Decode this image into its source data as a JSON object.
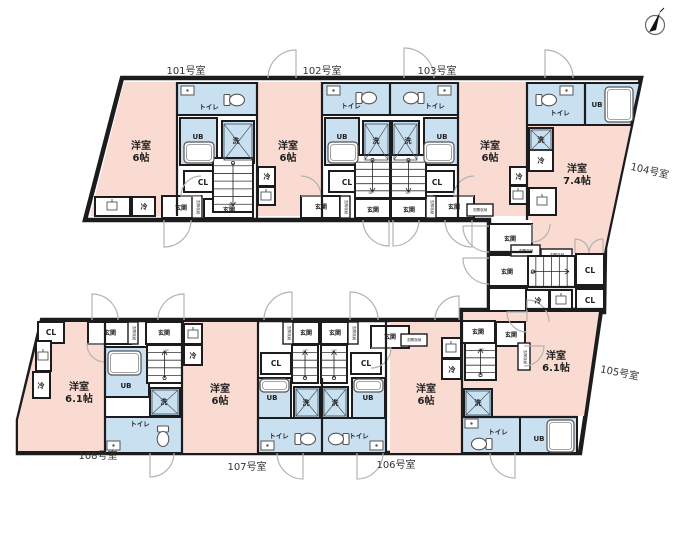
{
  "colors": {
    "wall": "#1c1c1e",
    "room_pink": "#f9dbd2",
    "wet_blue": "#c9e0f1",
    "door_arc": "#b3b3b3",
    "background": "#ffffff"
  },
  "units": [
    {
      "no": "101号室",
      "room": "洋室",
      "size": "6帖"
    },
    {
      "no": "102号室",
      "room": "洋室",
      "size": "6帖"
    },
    {
      "no": "103号室",
      "room": "洋室",
      "size": "6帖"
    },
    {
      "no": "104号室",
      "room": "洋室",
      "size": "7.4帖"
    },
    {
      "no": "105号室",
      "room": "洋室",
      "size": "6.1帖"
    },
    {
      "no": "106号室",
      "room": "洋室",
      "size": "6帖"
    },
    {
      "no": "107号室",
      "room": "洋室",
      "size": "6帖"
    },
    {
      "no": "108号室",
      "room": "洋室",
      "size": "6.1帖"
    }
  ],
  "legend": {
    "toilet": "トイレ",
    "unit_bath": "UB",
    "washer": "洗",
    "closet": "CL",
    "entrance": "玄関",
    "entrance_storage": "玄関収納",
    "fridge": "冷",
    "stairs_up": "UP"
  },
  "labels": [
    {
      "id": "unit-101",
      "t": "101号室",
      "x": 186,
      "y": 74,
      "c": "t-unit"
    },
    {
      "id": "unit-102",
      "t": "102号室",
      "x": 322,
      "y": 74,
      "c": "t-unit"
    },
    {
      "id": "unit-103",
      "t": "103号室",
      "x": 437,
      "y": 74,
      "c": "t-unit"
    },
    {
      "id": "unit-104",
      "t": "104号室",
      "x": 649,
      "y": 174,
      "c": "t-unit",
      "r": 13
    },
    {
      "id": "unit-105",
      "t": "105号室",
      "x": 619,
      "y": 376,
      "c": "t-unit",
      "r": 11
    },
    {
      "id": "unit-106",
      "t": "106号室",
      "x": 396,
      "y": 468,
      "c": "t-unit"
    },
    {
      "id": "unit-107",
      "t": "107号室",
      "x": 247,
      "y": 470,
      "c": "t-unit"
    },
    {
      "id": "unit-108",
      "t": "108号室",
      "x": 98,
      "y": 459,
      "c": "t-unit"
    },
    {
      "id": "room-101-type",
      "t": "洋室",
      "x": 141,
      "y": 149,
      "c": "t-room"
    },
    {
      "id": "room-101-size",
      "t": "6帖",
      "x": 141,
      "y": 161,
      "c": "t-room"
    },
    {
      "id": "room-102-type",
      "t": "洋室",
      "x": 288,
      "y": 149,
      "c": "t-room"
    },
    {
      "id": "room-102-size",
      "t": "6帖",
      "x": 288,
      "y": 161,
      "c": "t-room"
    },
    {
      "id": "room-103-type",
      "t": "洋室",
      "x": 490,
      "y": 149,
      "c": "t-room"
    },
    {
      "id": "room-103-size",
      "t": "6帖",
      "x": 490,
      "y": 161,
      "c": "t-room"
    },
    {
      "id": "room-104-type",
      "t": "洋室",
      "x": 577,
      "y": 172,
      "c": "t-room"
    },
    {
      "id": "room-104-size",
      "t": "7.4帖",
      "x": 577,
      "y": 184,
      "c": "t-room"
    },
    {
      "id": "room-105-type",
      "t": "洋室",
      "x": 556,
      "y": 359,
      "c": "t-room"
    },
    {
      "id": "room-105-size",
      "t": "6.1帖",
      "x": 556,
      "y": 371,
      "c": "t-room"
    },
    {
      "id": "room-106-type",
      "t": "洋室",
      "x": 426,
      "y": 392,
      "c": "t-room"
    },
    {
      "id": "room-106-size",
      "t": "6帖",
      "x": 426,
      "y": 404,
      "c": "t-room"
    },
    {
      "id": "room-107-type",
      "t": "洋室",
      "x": 220,
      "y": 392,
      "c": "t-room"
    },
    {
      "id": "room-107-size",
      "t": "6帖",
      "x": 220,
      "y": 404,
      "c": "t-room"
    },
    {
      "id": "room-108-type",
      "t": "洋室",
      "x": 79,
      "y": 390,
      "c": "t-room"
    },
    {
      "id": "room-108-size",
      "t": "6.1帖",
      "x": 79,
      "y": 402,
      "c": "t-room"
    },
    {
      "id": "toilet-101",
      "t": "トイレ",
      "x": 209,
      "y": 109,
      "c": "t-fix"
    },
    {
      "id": "toilet-102",
      "t": "トイレ",
      "x": 351,
      "y": 108,
      "c": "t-fix"
    },
    {
      "id": "toilet-103",
      "t": "トイレ",
      "x": 435,
      "y": 108,
      "c": "t-fix"
    },
    {
      "id": "toilet-104",
      "t": "トイレ",
      "x": 560,
      "y": 115,
      "c": "t-fix"
    },
    {
      "id": "toilet-105",
      "t": "トイレ",
      "x": 498,
      "y": 434,
      "c": "t-fix"
    },
    {
      "id": "toilet-106",
      "t": "トイレ",
      "x": 359,
      "y": 438,
      "c": "t-fix"
    },
    {
      "id": "toilet-107",
      "t": "トイレ",
      "x": 279,
      "y": 438,
      "c": "t-fix"
    },
    {
      "id": "toilet-108",
      "t": "トイレ",
      "x": 140,
      "y": 426,
      "c": "t-fix"
    },
    {
      "id": "ub-101",
      "t": "UB",
      "x": 198,
      "y": 139,
      "c": "t-fix7"
    },
    {
      "id": "ub-102",
      "t": "UB",
      "x": 342,
      "y": 139,
      "c": "t-fix7"
    },
    {
      "id": "ub-103",
      "t": "UB",
      "x": 442,
      "y": 139,
      "c": "t-fix7"
    },
    {
      "id": "ub-104",
      "t": "UB",
      "x": 597,
      "y": 107,
      "c": "t-fix7"
    },
    {
      "id": "ub-105",
      "t": "UB",
      "x": 539,
      "y": 441,
      "c": "t-fix7"
    },
    {
      "id": "ub-106",
      "t": "UB",
      "x": 368,
      "y": 400,
      "c": "t-fix7"
    },
    {
      "id": "ub-107",
      "t": "UB",
      "x": 272,
      "y": 400,
      "c": "t-fix7"
    },
    {
      "id": "ub-108",
      "t": "UB",
      "x": 126,
      "y": 388,
      "c": "t-fix7"
    },
    {
      "id": "wash-101",
      "t": "洗",
      "x": 236,
      "y": 143,
      "c": "t-fix7"
    },
    {
      "id": "wash-102",
      "t": "洗",
      "x": 376,
      "y": 143,
      "c": "t-fix7"
    },
    {
      "id": "wash-103",
      "t": "洗",
      "x": 408,
      "y": 143,
      "c": "t-fix7"
    },
    {
      "id": "wash-104",
      "t": "洗",
      "x": 541,
      "y": 142,
      "c": "t-fix7"
    },
    {
      "id": "wash-105",
      "t": "洗",
      "x": 478,
      "y": 405,
      "c": "t-fix7"
    },
    {
      "id": "wash-106",
      "t": "洗",
      "x": 335,
      "y": 405,
      "c": "t-fix7"
    },
    {
      "id": "wash-107",
      "t": "洗",
      "x": 306,
      "y": 405,
      "c": "t-fix7"
    },
    {
      "id": "wash-108",
      "t": "洗",
      "x": 164,
      "y": 404,
      "c": "t-fix7"
    },
    {
      "id": "cl-101",
      "t": "CL",
      "x": 203,
      "y": 185,
      "c": "t-cl"
    },
    {
      "id": "cl-102",
      "t": "CL",
      "x": 347,
      "y": 185,
      "c": "t-cl"
    },
    {
      "id": "cl-103",
      "t": "CL",
      "x": 437,
      "y": 185,
      "c": "t-cl"
    },
    {
      "id": "cl-mid-1",
      "t": "CL",
      "x": 590,
      "y": 273,
      "c": "t-cl"
    },
    {
      "id": "cl-mid-2",
      "t": "CL",
      "x": 590,
      "y": 303,
      "c": "t-cl"
    },
    {
      "id": "cl-106",
      "t": "CL",
      "x": 366,
      "y": 366,
      "c": "t-cl"
    },
    {
      "id": "cl-107",
      "t": "CL",
      "x": 276,
      "y": 366,
      "c": "t-cl"
    },
    {
      "id": "cl-108",
      "t": "CL",
      "x": 51,
      "y": 335,
      "c": "t-cl"
    },
    {
      "id": "genkan-101",
      "t": "玄関",
      "x": 181,
      "y": 210,
      "c": "t-gen"
    },
    {
      "id": "genkan-101b",
      "t": "玄関",
      "x": 229,
      "y": 212,
      "c": "t-gen"
    },
    {
      "id": "genkan-102",
      "t": "玄関",
      "x": 321,
      "y": 209,
      "c": "t-gen"
    },
    {
      "id": "genkan-102b",
      "t": "玄関",
      "x": 373,
      "y": 212,
      "c": "t-gen"
    },
    {
      "id": "genkan-103b",
      "t": "玄関",
      "x": 409,
      "y": 212,
      "c": "t-gen"
    },
    {
      "id": "genkan-103",
      "t": "玄関",
      "x": 454,
      "y": 209,
      "c": "t-gen"
    },
    {
      "id": "genkan-104",
      "t": "玄関",
      "x": 510,
      "y": 241,
      "c": "t-gen"
    },
    {
      "id": "genkan-105",
      "t": "玄関",
      "x": 507,
      "y": 274,
      "c": "t-gen"
    },
    {
      "id": "genkan-108",
      "t": "玄関",
      "x": 110,
      "y": 335,
      "c": "t-gen"
    },
    {
      "id": "genkan-107",
      "t": "玄関",
      "x": 164,
      "y": 335,
      "c": "t-gen"
    },
    {
      "id": "genkan-107b",
      "t": "玄関",
      "x": 306,
      "y": 335,
      "c": "t-gen"
    },
    {
      "id": "genkan-106b",
      "t": "玄関",
      "x": 335,
      "y": 335,
      "c": "t-gen"
    },
    {
      "id": "genkan-106",
      "t": "玄関",
      "x": 390,
      "y": 339,
      "c": "t-gen"
    },
    {
      "id": "genkan-105b",
      "t": "玄関",
      "x": 478,
      "y": 334,
      "c": "t-gen"
    },
    {
      "id": "genkan-105c",
      "t": "玄関",
      "x": 511,
      "y": 337,
      "c": "t-gen"
    },
    {
      "id": "storage-1",
      "t": "玄関収納",
      "x": 197,
      "y": 207,
      "c": "t-tiny",
      "v": 1
    },
    {
      "id": "storage-2",
      "t": "玄関収納",
      "x": 345,
      "y": 207,
      "c": "t-tiny",
      "v": 1
    },
    {
      "id": "storage-3",
      "t": "玄関収納",
      "x": 431,
      "y": 207,
      "c": "t-tiny",
      "v": 1
    },
    {
      "id": "storage-4",
      "t": "玄関収納",
      "x": 480,
      "y": 211,
      "c": "t-tiny"
    },
    {
      "id": "storage-5",
      "t": "玄関収納",
      "x": 526,
      "y": 252,
      "c": "t-tiny"
    },
    {
      "id": "storage-6",
      "t": "玄関収納",
      "x": 557,
      "y": 256,
      "c": "t-tiny"
    },
    {
      "id": "storage-7",
      "t": "玄関収納",
      "x": 133,
      "y": 333,
      "c": "t-tiny",
      "v": 1
    },
    {
      "id": "storage-8",
      "t": "玄関収納",
      "x": 288,
      "y": 333,
      "c": "t-tiny",
      "v": 1
    },
    {
      "id": "storage-9",
      "t": "玄関収納",
      "x": 353,
      "y": 333,
      "c": "t-tiny",
      "v": 1
    },
    {
      "id": "storage-10",
      "t": "玄関収納",
      "x": 414,
      "y": 341,
      "c": "t-tiny"
    },
    {
      "id": "storage-11",
      "t": "玄関収納",
      "x": 524,
      "y": 357,
      "c": "t-tiny",
      "v": 1
    },
    {
      "id": "fridge-101",
      "t": "冷",
      "x": 144,
      "y": 209,
      "c": "t-fix7"
    },
    {
      "id": "fridge-102",
      "t": "冷",
      "x": 267,
      "y": 179,
      "c": "t-fix7"
    },
    {
      "id": "fridge-103",
      "t": "冷",
      "x": 519,
      "y": 179,
      "c": "t-fix7"
    },
    {
      "id": "fridge-104",
      "t": "冷",
      "x": 541,
      "y": 163,
      "c": "t-fix7"
    },
    {
      "id": "fridge-105",
      "t": "冷",
      "x": 538,
      "y": 303,
      "c": "t-fix7"
    },
    {
      "id": "fridge-106",
      "t": "冷",
      "x": 452,
      "y": 372,
      "c": "t-fix7"
    },
    {
      "id": "fridge-107",
      "t": "冷",
      "x": 193,
      "y": 358,
      "c": "t-fix7"
    },
    {
      "id": "fridge-108",
      "t": "冷",
      "x": 41,
      "y": 388,
      "c": "t-fix7"
    },
    {
      "id": "up-1",
      "t": "UP",
      "x": 231,
      "y": 206,
      "c": "t-up"
    },
    {
      "id": "up-2",
      "t": "UP",
      "x": 371,
      "y": 194,
      "c": "t-up"
    },
    {
      "id": "up-3",
      "t": "UP",
      "x": 408,
      "y": 194,
      "c": "t-up"
    },
    {
      "id": "up-4",
      "t": "UP",
      "x": 533,
      "y": 274,
      "c": "t-up"
    },
    {
      "id": "up-5",
      "t": "UP",
      "x": 166,
      "y": 352,
      "c": "t-up"
    },
    {
      "id": "up-6",
      "t": "UP",
      "x": 305,
      "y": 352,
      "c": "t-up"
    },
    {
      "id": "up-7",
      "t": "UP",
      "x": 334,
      "y": 352,
      "c": "t-up"
    },
    {
      "id": "up-8",
      "t": "UP",
      "x": 481,
      "y": 351,
      "c": "t-up"
    }
  ]
}
